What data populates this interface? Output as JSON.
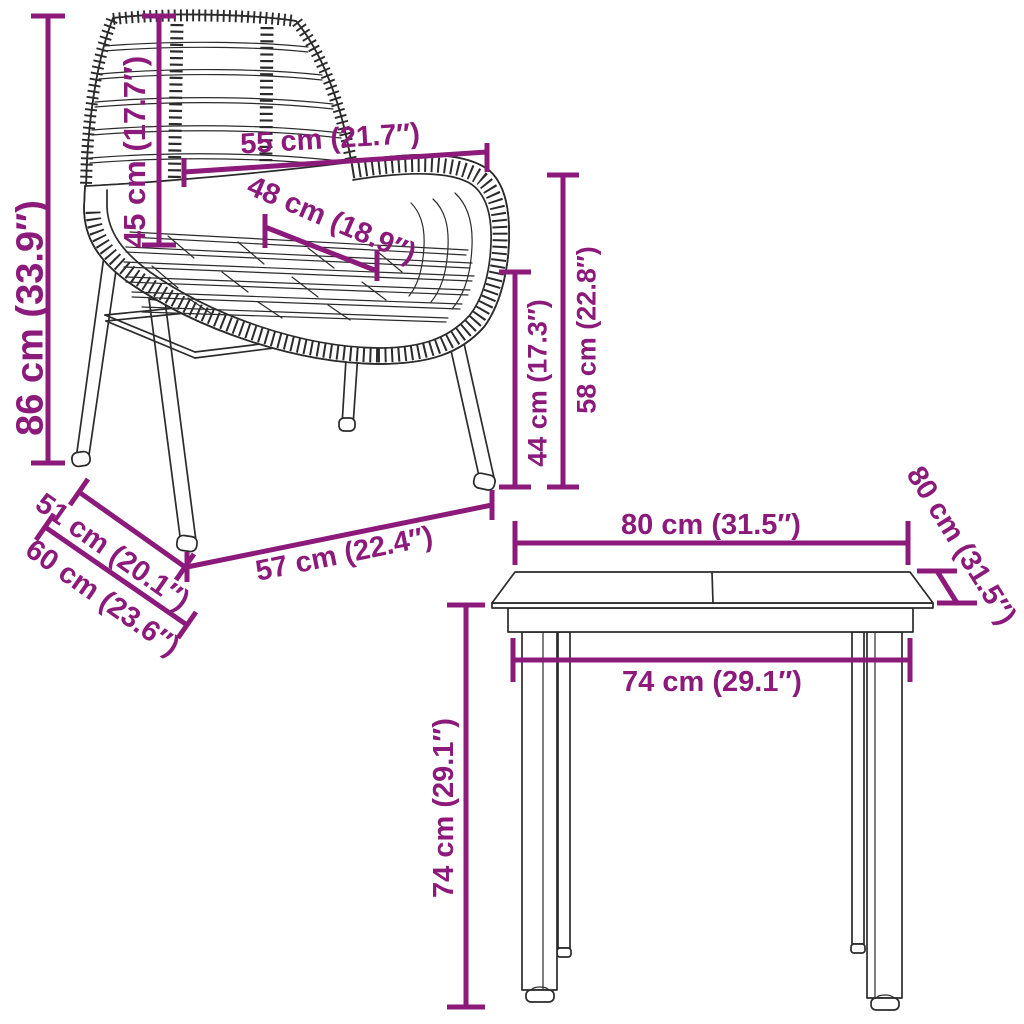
{
  "diagram": {
    "type": "furniture-dimension-diagram",
    "colors": {
      "dimension": "#8B1A7B",
      "line": "#2B2B2B",
      "background": "#FFFFFF"
    },
    "chair": {
      "item": "rattan-dining-chair",
      "dimensions": {
        "height": {
          "label": "86 cm (33.9″)",
          "cm": 86,
          "in": 33.9
        },
        "backrest_height": {
          "label": "45 cm (17.7″)",
          "cm": 45,
          "in": 17.7
        },
        "top_width": {
          "label": "55 cm (21.7″)",
          "cm": 55,
          "in": 21.7
        },
        "seat_depth": {
          "label": "48 cm (18.9″)",
          "cm": 48,
          "in": 18.9
        },
        "seat_height": {
          "label": "44 cm (17.3″)",
          "cm": 44,
          "in": 17.3
        },
        "armrest_height": {
          "label": "58 cm (22.8″)",
          "cm": 58,
          "in": 22.8
        },
        "depth_upper": {
          "label": "51 cm (20.1″)",
          "cm": 51,
          "in": 20.1
        },
        "depth_total": {
          "label": "60 cm (23.6″)",
          "cm": 60,
          "in": 23.6
        },
        "base_width": {
          "label": "57 cm (22.4″)",
          "cm": 57,
          "in": 22.4
        }
      }
    },
    "table": {
      "item": "dining-table",
      "dimensions": {
        "top_width": {
          "label": "80 cm (31.5″)",
          "cm": 80,
          "in": 31.5
        },
        "top_depth": {
          "label": "80 cm (31.5″)",
          "cm": 80,
          "in": 31.5
        },
        "inner_width": {
          "label": "74 cm (29.1″)",
          "cm": 74,
          "in": 29.1
        },
        "height": {
          "label": "74 cm (29.1″)",
          "cm": 74,
          "in": 29.1
        }
      }
    }
  }
}
